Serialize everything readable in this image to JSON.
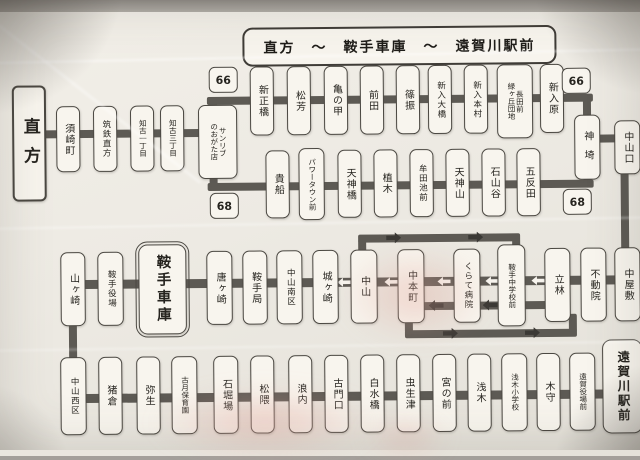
{
  "map": {
    "title": "直方　〜　鞍手車庫　〜　遠賀川駅前",
    "terminals": {
      "west": "直方",
      "depot": "鞍手車庫",
      "east": "遠賀川駅前"
    },
    "badges": {
      "r66": "66",
      "r68": "68"
    },
    "feeder_stations": [
      "須崎町",
      "筑鉄直方",
      "知古一丁目",
      "知古三丁目",
      "サンリブ\nのおがた店"
    ],
    "route66_stations": [
      "新正橋",
      "松芳",
      "亀の甲",
      "前田",
      "篠振",
      "新入大橋",
      "新入本村",
      "長田前\n緑ヶ丘団地",
      "新入原"
    ],
    "route68_stations": [
      "貴船",
      "パワータウン前",
      "天神橋",
      "植木",
      "牟田池前",
      "天神山",
      "石山谷",
      "五反田"
    ],
    "junction_stations": [
      "神埼",
      "中山口"
    ],
    "middle_stations": [
      "山ヶ崎",
      "鞍手役場",
      "唐ヶ崎",
      "鞍手局",
      "中山南区",
      "城ヶ崎",
      "中山",
      "中本町",
      "くらて病院",
      "鞍手中学校前",
      "立林",
      "不動院",
      "中屋敷"
    ],
    "bottom_stations": [
      "中山西区",
      "猪倉",
      "弥生",
      "古月保育園",
      "石堀場",
      "松隈",
      "浪内",
      "古門口",
      "白水橋",
      "虫生津",
      "宮の前",
      "浅木",
      "浅木小学校",
      "木守",
      "遠賀役場前"
    ],
    "colors": {
      "line": "#5d5a54",
      "box_fill": "#f8f5ee",
      "box_border": "#4b4842",
      "paper": "#edeae3"
    }
  }
}
